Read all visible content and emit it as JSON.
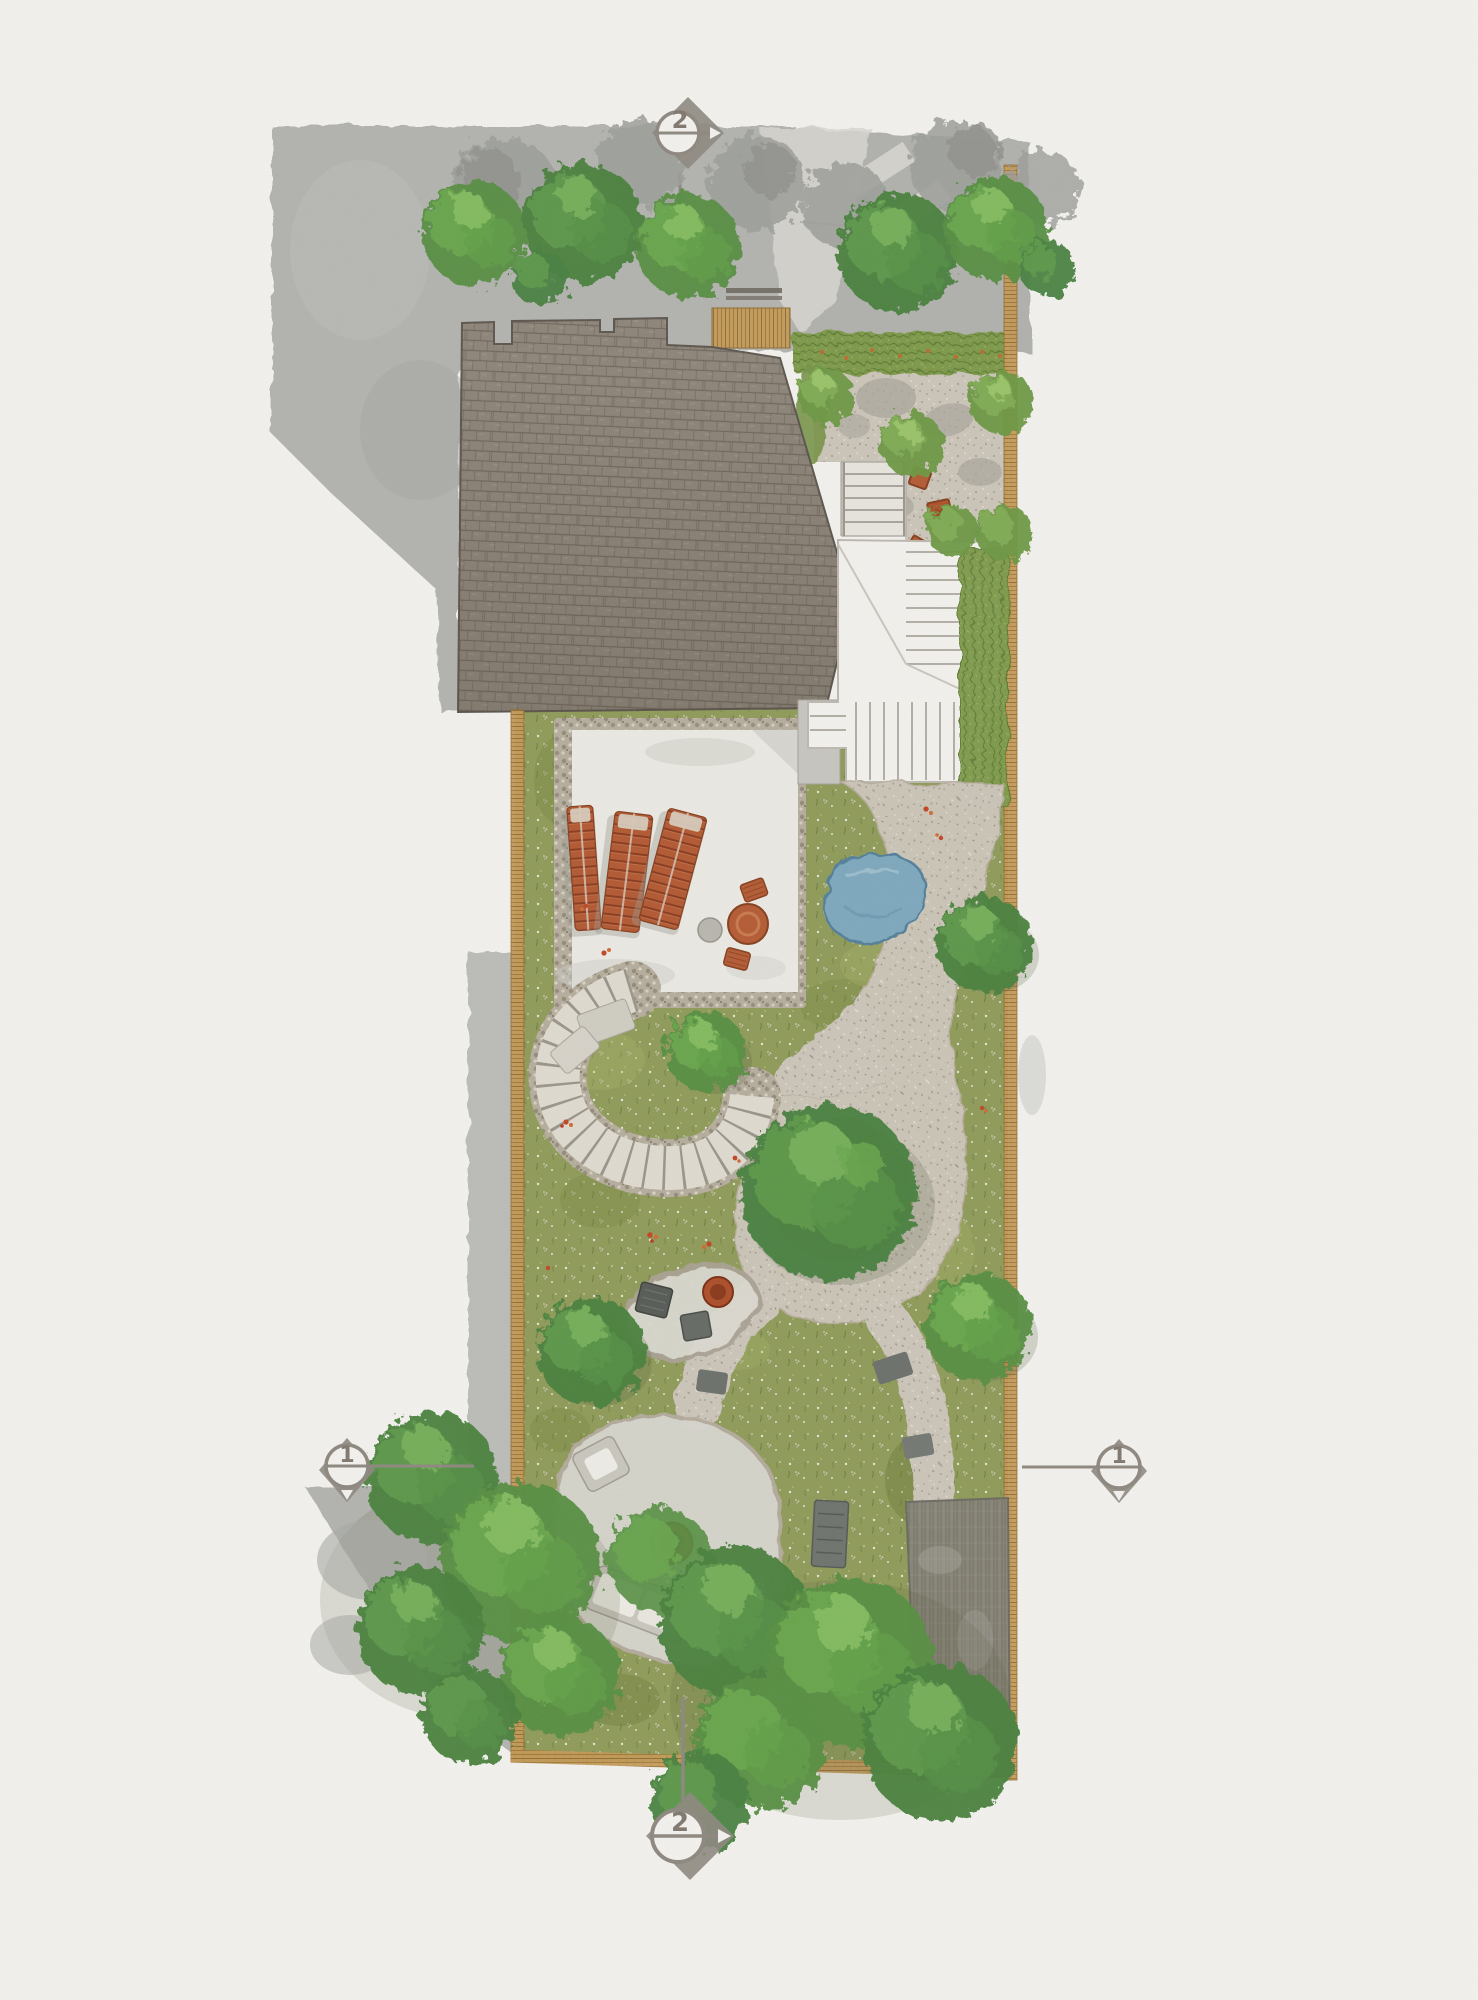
{
  "plan": {
    "section_markers": {
      "top": {
        "label": "2",
        "orientation": "vertical-section-line"
      },
      "bottom": {
        "label": "2",
        "orientation": "vertical-section-line"
      },
      "left": {
        "label": "1",
        "orientation": "horizontal-section-line"
      },
      "right": {
        "label": "1",
        "orientation": "horizontal-section-line"
      }
    }
  },
  "palette": {
    "paper": "#f2f1ed",
    "neighbour_paving": "#b2b3af",
    "roof_shingle": "#8e8579",
    "meadow_green": "#8f9b5a",
    "gravel": "#cbc5b9",
    "stone_patio": "#eae8e2",
    "pond_blue": "#7fa8bd",
    "terracotta": "#b45c36",
    "fence_timber": "#c49a58",
    "tree_green": "#578f43",
    "marker_gray": "#8e8880"
  }
}
